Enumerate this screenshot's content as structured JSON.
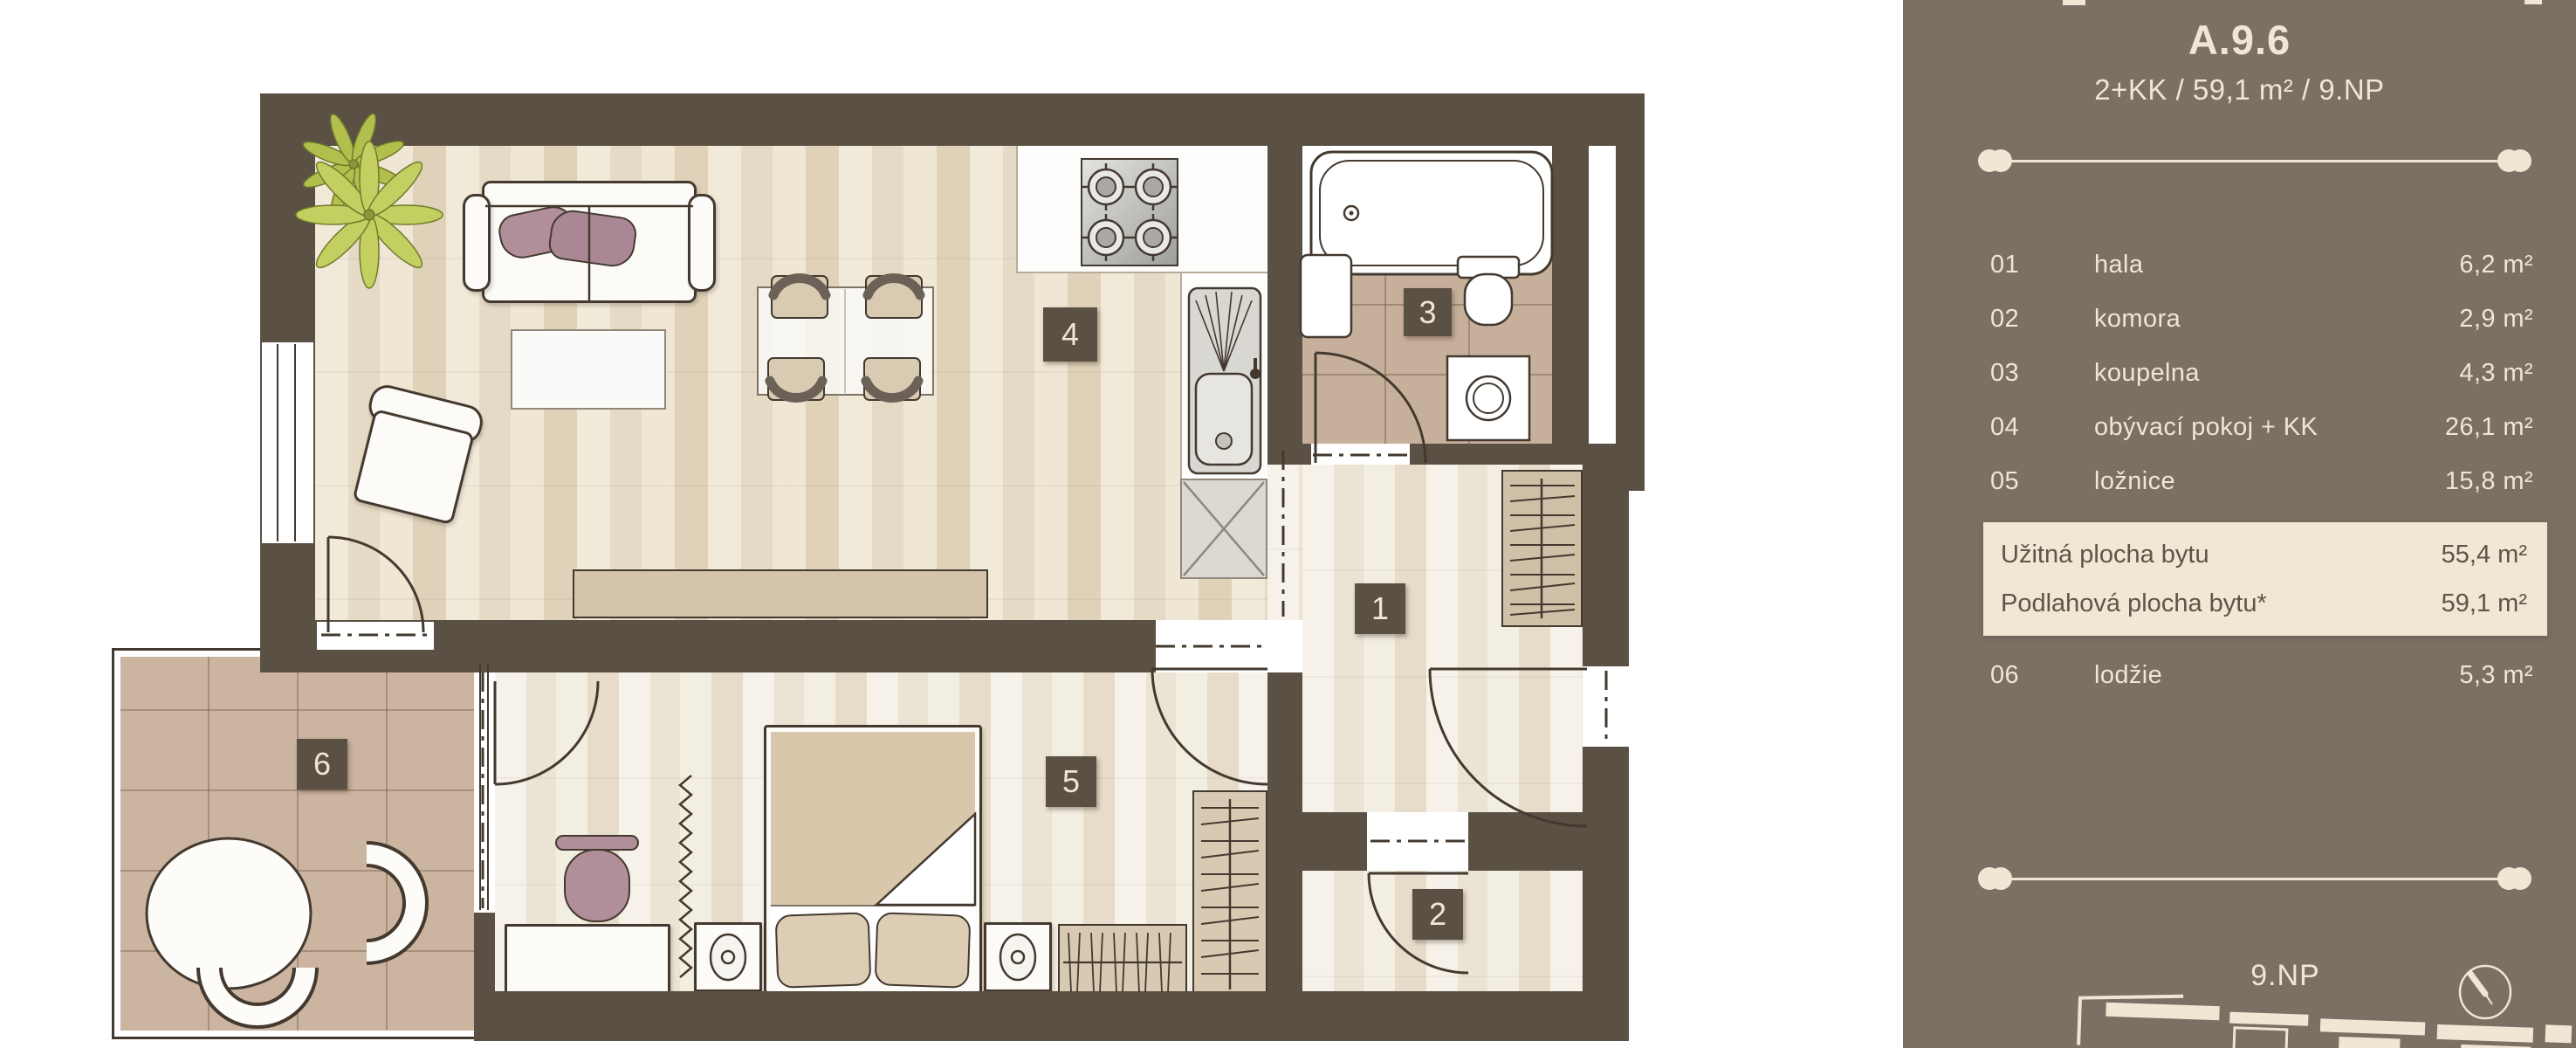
{
  "unit": {
    "title": "A.9.6",
    "subtitle": "2+KK / 59,1 m² / 9.NP"
  },
  "sidebar": {
    "rooms": [
      {
        "num": "01",
        "label": "hala",
        "area": "6,2 m²"
      },
      {
        "num": "02",
        "label": "komora",
        "area": "2,9 m²"
      },
      {
        "num": "03",
        "label": "koupelna",
        "area": "4,3 m²"
      },
      {
        "num": "04",
        "label": "obývací pokoj + KK",
        "area": "26,1 m²"
      },
      {
        "num": "05",
        "label": "ložnice",
        "area": "15,8 m²"
      }
    ],
    "totals": [
      {
        "label": "Užitná plocha bytu",
        "value": "55,4 m²"
      },
      {
        "label": "Podlahová plocha bytu*",
        "value": "59,1 m²"
      }
    ],
    "extra_room": {
      "num": "06",
      "label": "lodžie",
      "area": "5,3 m²"
    },
    "floor_label": "9.NP",
    "colors": {
      "background": "#7a7064",
      "text": "#efe6d4",
      "highlight_bg": "#f1e7d4",
      "highlight_text": "#5f5449"
    }
  },
  "plan": {
    "tags": [
      "1",
      "2",
      "3",
      "4",
      "5",
      "6"
    ],
    "colors": {
      "wall": "#5a5043",
      "wood": "#ebe2d2",
      "tile": "#c7b09b",
      "plant_green": "#bcc75a",
      "cushion_mauve": "#b08e9a"
    }
  }
}
